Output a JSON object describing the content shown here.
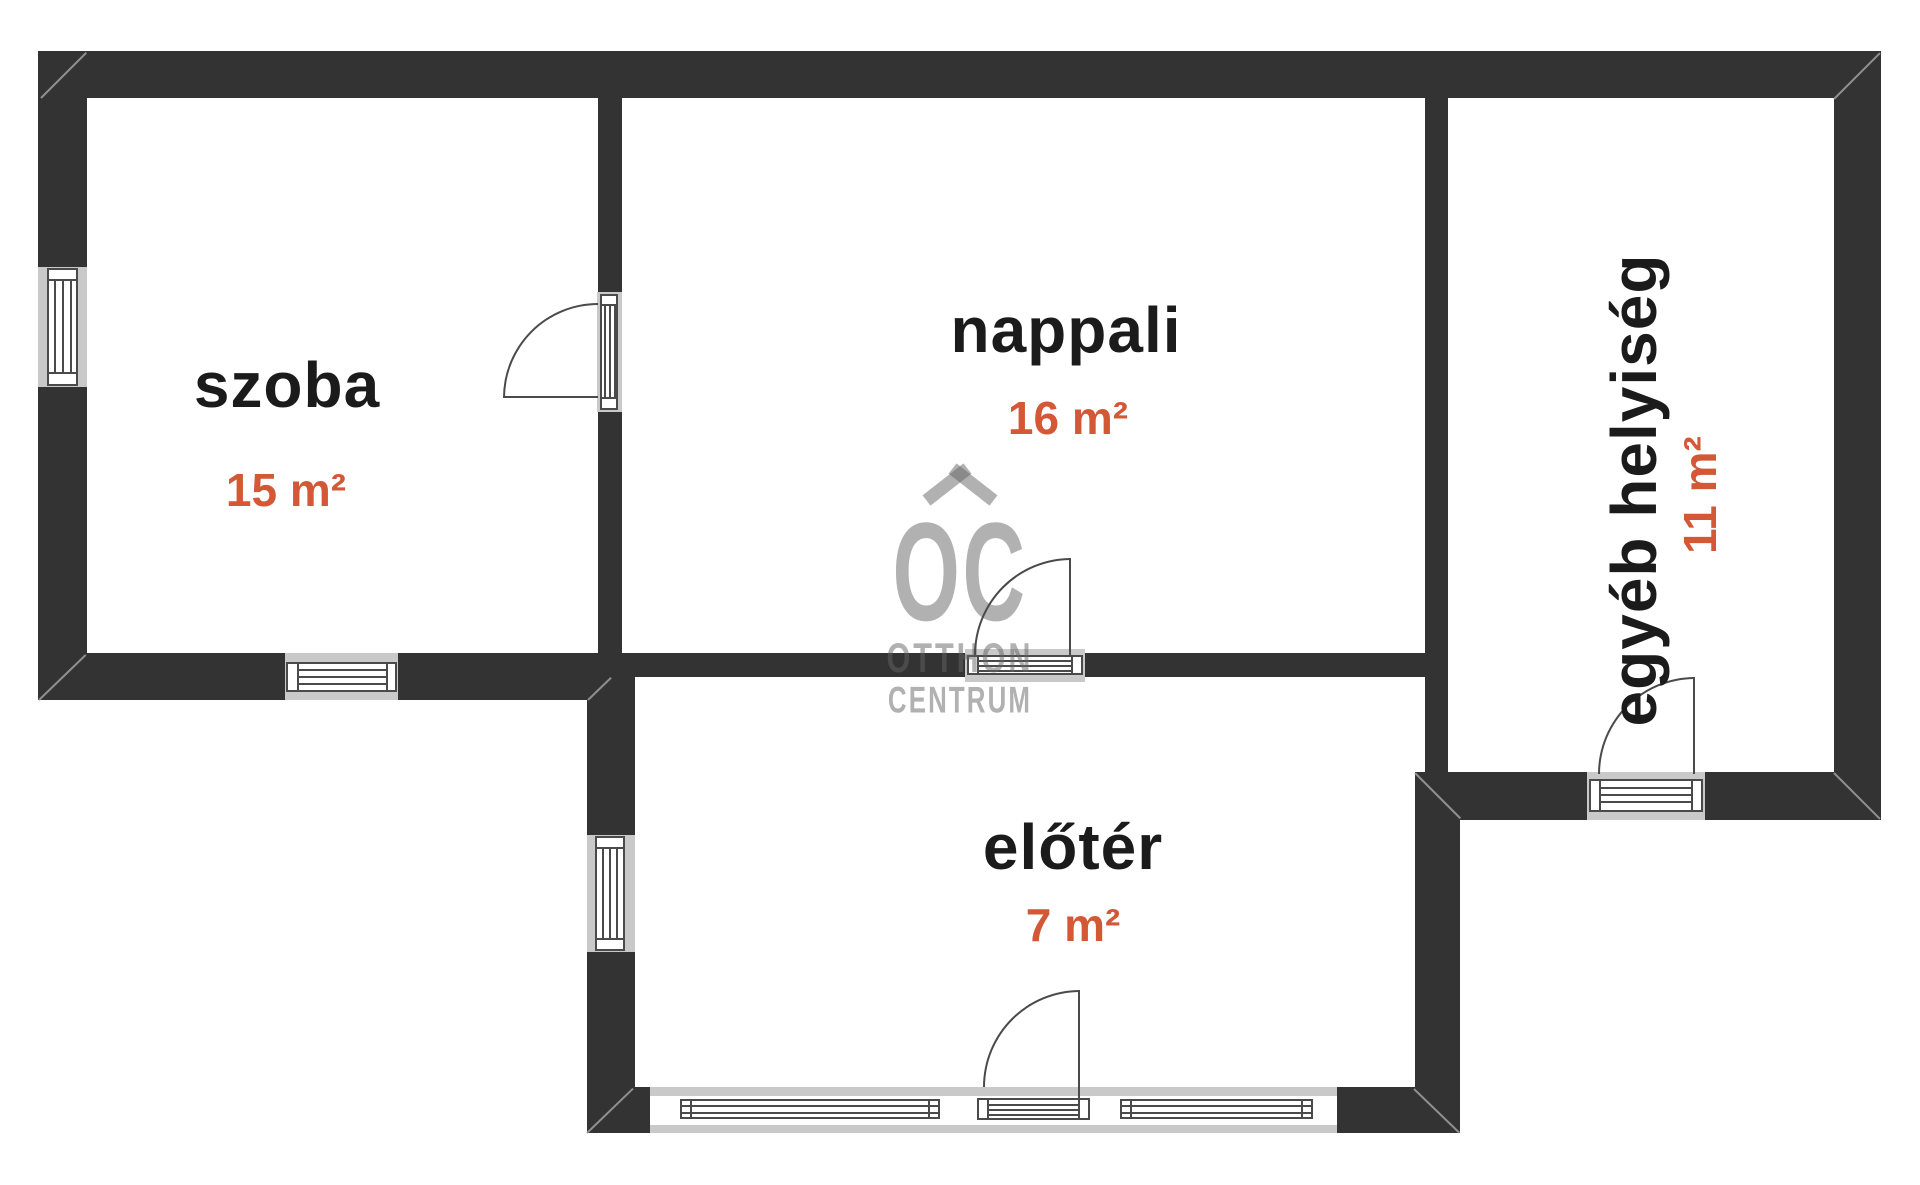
{
  "title": "floor-plan",
  "colors": {
    "wall": "#333333",
    "window_frame_gray": "#c9c9c9",
    "drawing_line": "#4a4a4a",
    "room_label_text": "#1b1b1b",
    "area_text_orange": "#d25836",
    "watermark_gray": "#b4b4b4"
  },
  "rooms": [
    {
      "id": "szoba",
      "label": "szoba",
      "area": "15 m²"
    },
    {
      "id": "nappali",
      "label": "nappali",
      "area": "16 m²"
    },
    {
      "id": "eloter",
      "label": "előtér",
      "area": "7 m²"
    },
    {
      "id": "egyeb",
      "label": "egyéb helyiség",
      "area": "11 m²"
    }
  ],
  "watermark": {
    "logo": "OC",
    "line1": "OTTHON",
    "line2": "CENTRUM"
  }
}
